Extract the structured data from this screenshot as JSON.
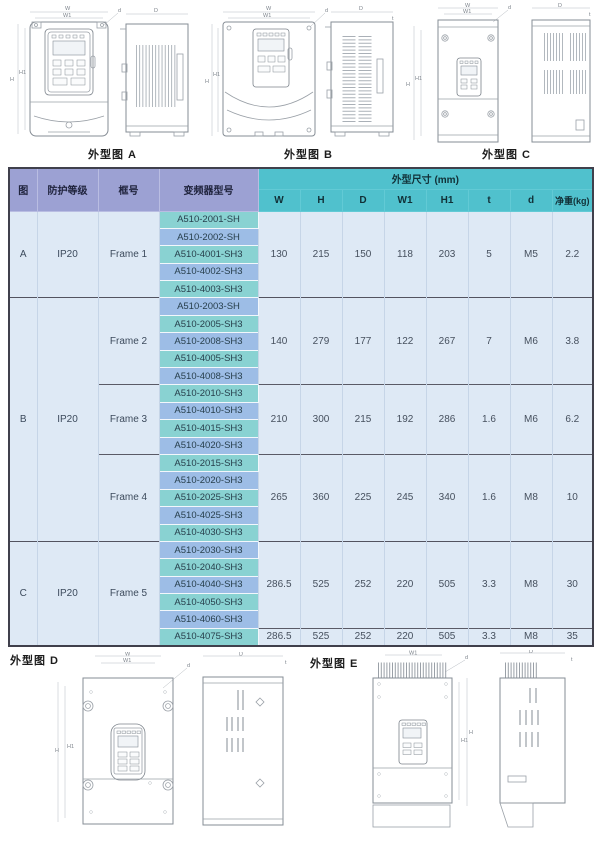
{
  "drawings": {
    "caption_a": "外型图 A",
    "caption_b": "外型图 B",
    "caption_c": "外型图 C",
    "caption_d": "外型图 D",
    "caption_e": "外型图 E",
    "dim_labels": {
      "w": "W",
      "w1": "W1",
      "h": "H",
      "h1": "H1",
      "depth": "D",
      "screw": "d",
      "t": "t"
    }
  },
  "table": {
    "header": {
      "fig": "图",
      "protection": "防护等级",
      "frame": "框号",
      "model": "变频器型号",
      "dims_group": "外型尺寸 (mm)",
      "cols": [
        "W",
        "H",
        "D",
        "W1",
        "H1",
        "t",
        "d",
        "净重(kg)"
      ]
    },
    "sections": [
      {
        "fig": "A",
        "protection": "IP20",
        "frames": [
          {
            "name": "Frame 1",
            "models": [
              "A510-2001-SH",
              "A510-2002-SH",
              "A510-4001-SH3",
              "A510-4002-SH3",
              "A510-4003-SH3"
            ],
            "dims": [
              "130",
              "215",
              "150",
              "118",
              "203",
              "5",
              "M5",
              "2.2"
            ]
          }
        ]
      },
      {
        "fig": "B",
        "protection": "IP20",
        "frames": [
          {
            "name": "Frame 2",
            "models": [
              "A510-2003-SH",
              "A510-2005-SH3",
              "A510-2008-SH3",
              "A510-4005-SH3",
              "A510-4008-SH3"
            ],
            "dims": [
              "140",
              "279",
              "177",
              "122",
              "267",
              "7",
              "M6",
              "3.8"
            ]
          },
          {
            "name": "Frame 3",
            "models": [
              "A510-2010-SH3",
              "A510-4010-SH3",
              "A510-4015-SH3",
              "A510-4020-SH3"
            ],
            "dims": [
              "210",
              "300",
              "215",
              "192",
              "286",
              "1.6",
              "M6",
              "6.2"
            ]
          },
          {
            "name": "Frame 4",
            "models": [
              "A510-2015-SH3",
              "A510-2020-SH3",
              "A510-2025-SH3",
              "A510-4025-SH3",
              "A510-4030-SH3"
            ],
            "dims": [
              "265",
              "360",
              "225",
              "245",
              "340",
              "1.6",
              "M8",
              "10"
            ]
          }
        ]
      },
      {
        "fig": "C",
        "protection": "IP20",
        "frames": [
          {
            "name": "Frame 5",
            "models": [
              "A510-2030-SH3",
              "A510-2040-SH3",
              "A510-4040-SH3",
              "A510-4050-SH3",
              "A510-4060-SH3",
              "A510-4075-SH3"
            ],
            "dims": [
              "286.5",
              "525",
              "252",
              "220",
              "505",
              "3.3",
              "M8",
              "30"
            ],
            "dims_last": [
              "286.5",
              "525",
              "252",
              "220",
              "505",
              "3.3",
              "M8",
              "35"
            ]
          }
        ]
      }
    ]
  }
}
